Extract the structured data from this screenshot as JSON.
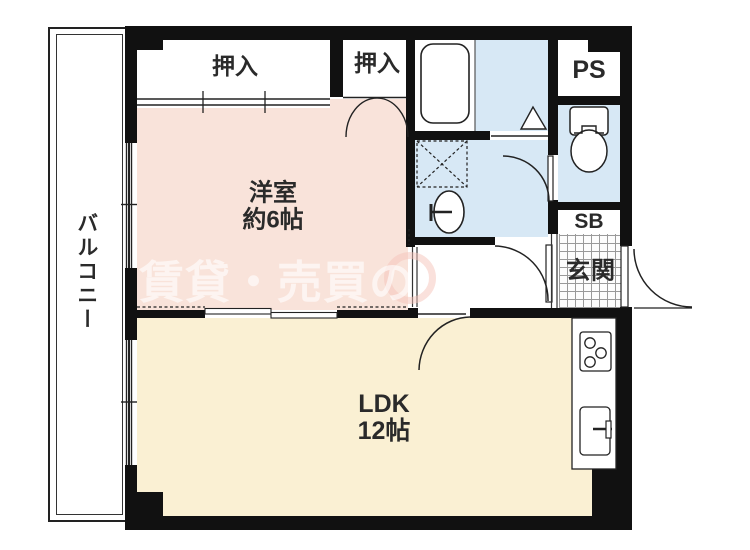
{
  "plan": {
    "title": "apartment-floorplan-1ldk",
    "rooms": {
      "balcony": "バルコニー",
      "closet1": "押入",
      "closet2": "押入",
      "western_name": "洋室",
      "western_size": "約6帖",
      "ldk_name": "LDK",
      "ldk_size": "12帖",
      "pipe_space": "PS",
      "shoe_box": "SB",
      "entrance": "玄関"
    },
    "watermark_text": "賃貸・売買の",
    "colors": {
      "room_pink": "#f9e3da",
      "room_cream": "#faf0d3",
      "room_blue": "#d7e8f5",
      "wall": "#111111",
      "watermark": "rgba(255,255,255,0.62)"
    }
  }
}
